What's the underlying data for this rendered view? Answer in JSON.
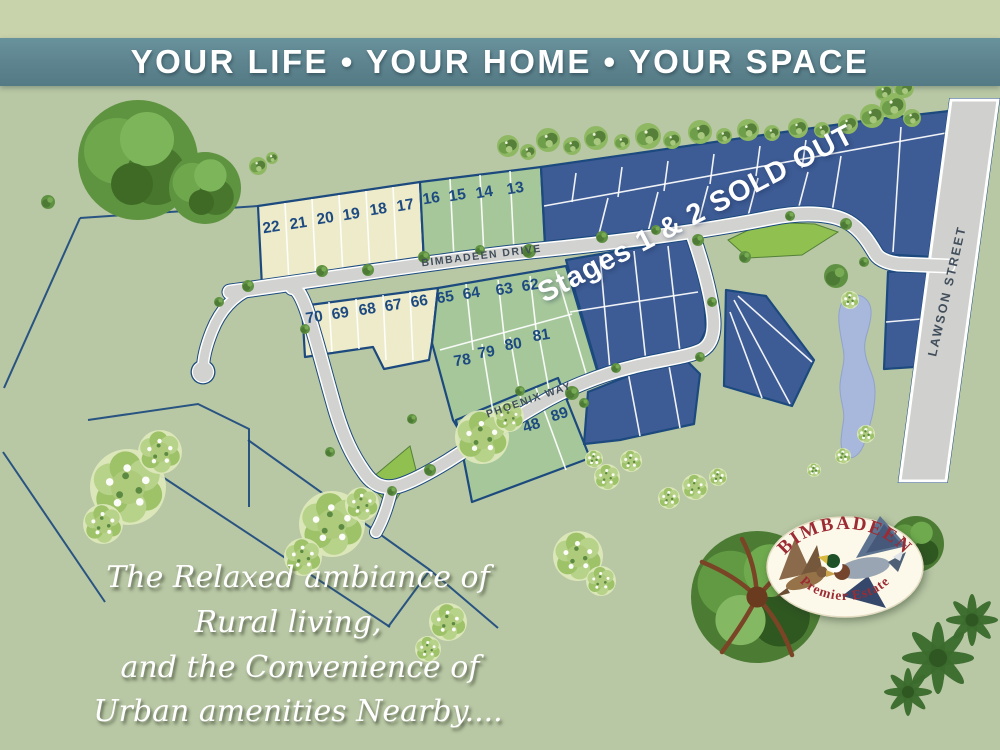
{
  "banner": {
    "text": "YOUR LIFE • YOUR HOME • YOUR SPACE"
  },
  "map": {
    "sold_notice": "Stages 1 & 2 SOLD OUT",
    "streets": [
      {
        "id": "bimbadeen-drive",
        "label": "BIMBADEEN DRIVE"
      },
      {
        "id": "phoenix-way",
        "label": "PHOENIX WAY"
      },
      {
        "id": "lawson-street",
        "label": "LAWSON STREET"
      }
    ],
    "lots": [
      {
        "number": "22",
        "x": 272,
        "y": 232,
        "r": -9,
        "type": "premium"
      },
      {
        "number": "21",
        "x": 299,
        "y": 228,
        "r": -9,
        "type": "premium"
      },
      {
        "number": "20",
        "x": 326,
        "y": 223,
        "r": -9,
        "type": "premium"
      },
      {
        "number": "19",
        "x": 352,
        "y": 219,
        "r": -9,
        "type": "premium"
      },
      {
        "number": "18",
        "x": 379,
        "y": 214,
        "r": -9,
        "type": "premium"
      },
      {
        "number": "17",
        "x": 406,
        "y": 210,
        "r": -9,
        "type": "premium"
      },
      {
        "number": "16",
        "x": 432,
        "y": 203,
        "r": -9,
        "type": "standard"
      },
      {
        "number": "15",
        "x": 458,
        "y": 200,
        "r": -9,
        "type": "standard"
      },
      {
        "number": "14",
        "x": 485,
        "y": 197,
        "r": -9,
        "type": "standard"
      },
      {
        "number": "13",
        "x": 516,
        "y": 193,
        "r": -9,
        "type": "standard"
      },
      {
        "number": "70",
        "x": 315,
        "y": 322,
        "r": -9,
        "type": "premium"
      },
      {
        "number": "69",
        "x": 341,
        "y": 318,
        "r": -9,
        "type": "premium"
      },
      {
        "number": "68",
        "x": 368,
        "y": 314,
        "r": -9,
        "type": "premium"
      },
      {
        "number": "67",
        "x": 394,
        "y": 310,
        "r": -9,
        "type": "premium"
      },
      {
        "number": "66",
        "x": 420,
        "y": 306,
        "r": -9,
        "type": "premium"
      },
      {
        "number": "65",
        "x": 446,
        "y": 302,
        "r": -9,
        "type": "standard"
      },
      {
        "number": "64",
        "x": 472,
        "y": 298,
        "r": -9,
        "type": "standard"
      },
      {
        "number": "63",
        "x": 505,
        "y": 294,
        "r": -9,
        "type": "standard"
      },
      {
        "number": "62",
        "x": 531,
        "y": 290,
        "r": -9,
        "type": "standard"
      },
      {
        "number": "78",
        "x": 463,
        "y": 365,
        "r": -9,
        "type": "standard"
      },
      {
        "number": "79",
        "x": 487,
        "y": 357,
        "r": -9,
        "type": "standard"
      },
      {
        "number": "80",
        "x": 514,
        "y": 349,
        "r": -9,
        "type": "standard"
      },
      {
        "number": "81",
        "x": 542,
        "y": 340,
        "r": -9,
        "type": "standard"
      },
      {
        "number": "48",
        "x": 533,
        "y": 430,
        "r": -18,
        "type": "standard"
      },
      {
        "number": "89",
        "x": 561,
        "y": 419,
        "r": -18,
        "type": "standard"
      }
    ]
  },
  "tagline": {
    "lines": [
      "The Relaxed ambiance of",
      "Rural living,",
      "and the Convenience of",
      "Urban amenities Nearby...."
    ]
  },
  "logo": {
    "title": "BIMBADEEN",
    "subtitle": "Premier Estate"
  },
  "colors": {
    "banner_bg": "#5d838e",
    "top_strip": "#c9d3ab",
    "background": "#b8c7a4",
    "premium_lot": "#edebca",
    "standard_lot": "#a5c79a",
    "sold_lot": "#3d5b94",
    "boundary": "#1c4a7e",
    "road": "#d2d2d0",
    "pond": "#a8b8dc",
    "park": "#8ec04b",
    "logo_text": "#9c2b33"
  }
}
